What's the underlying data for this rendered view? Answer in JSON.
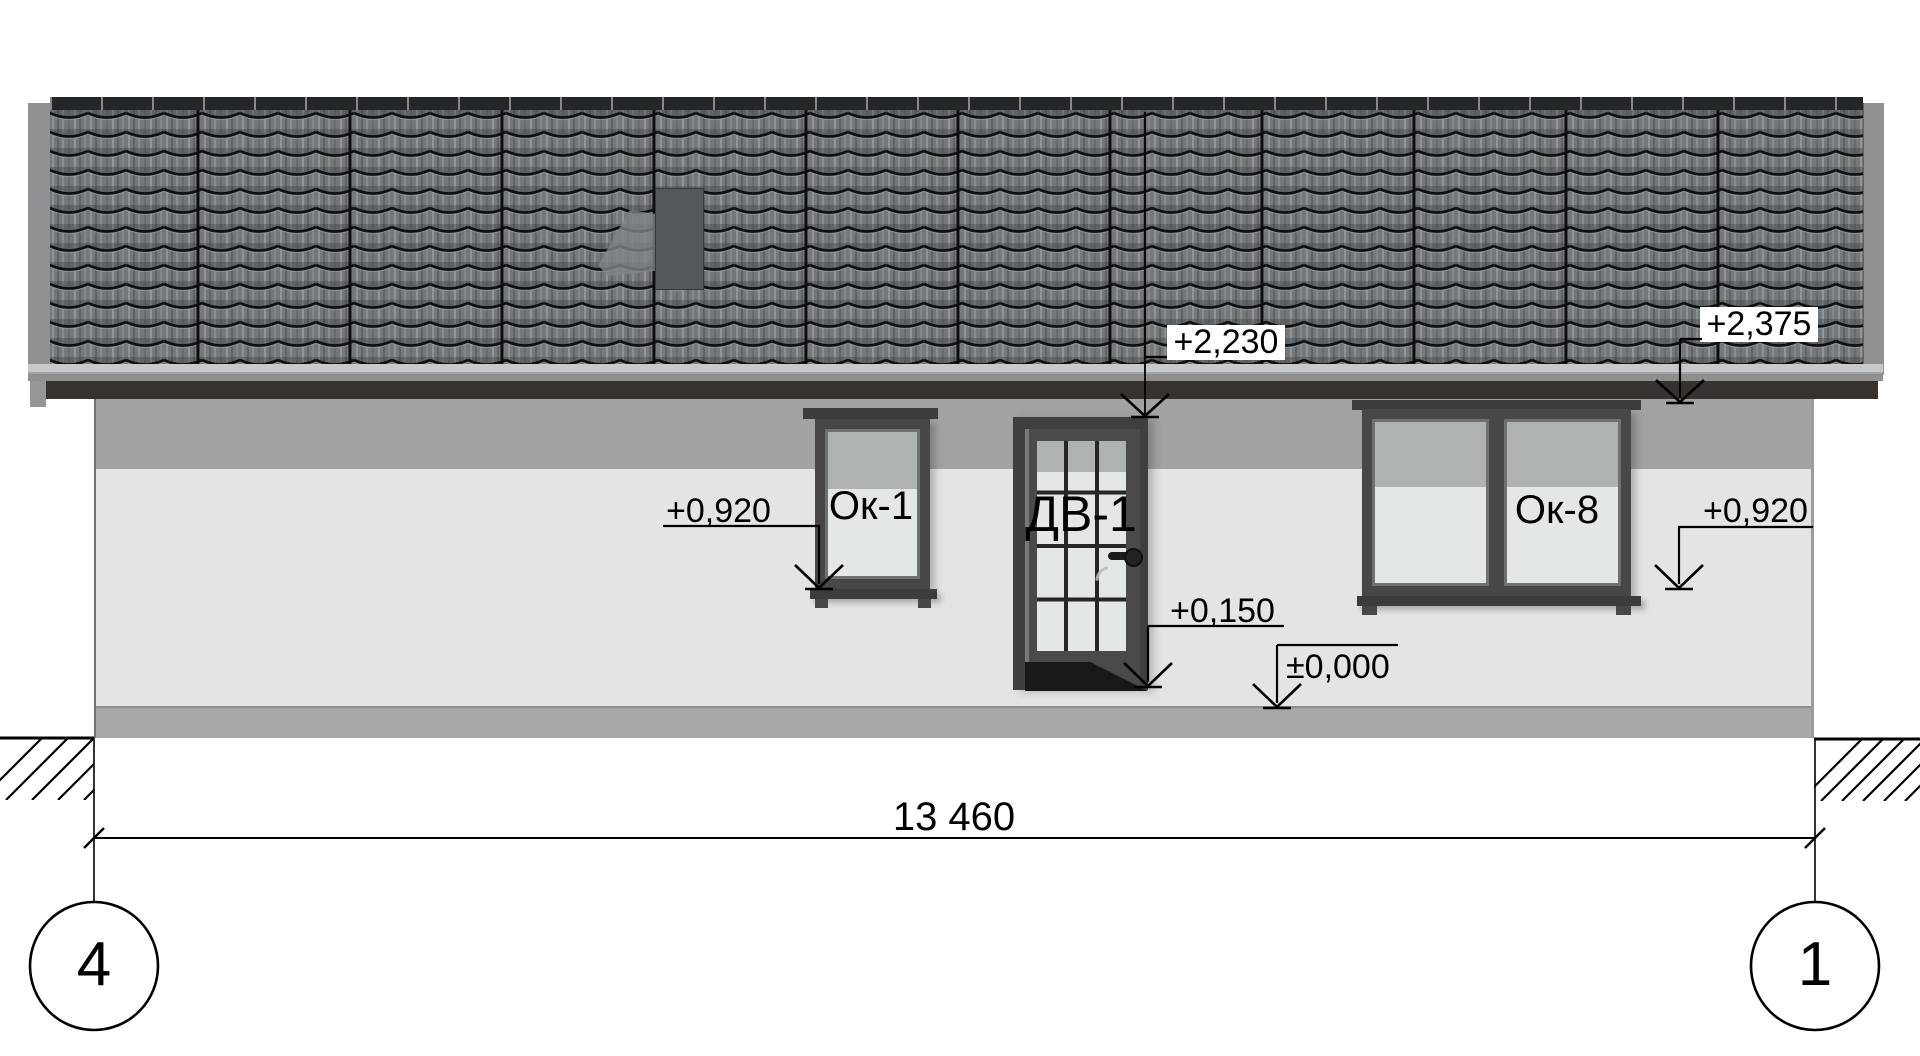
{
  "drawing": {
    "kind": "house facade elevation",
    "tags": {
      "window_left": "Ок-1",
      "door": "ДВ-1",
      "window_right": "Ок-8"
    },
    "elevation_marks": {
      "door_head": "+2,230",
      "roof_eave": "+2,375",
      "window_sill_left": "+0,920",
      "door_threshold": "+0,150",
      "ground_zero": "±0,000",
      "window_sill_right": "+0,920"
    },
    "dimension": {
      "overall_width": "13 460"
    },
    "grid_axes": {
      "left_bubble": "4",
      "right_bubble": "1"
    }
  },
  "colors": {
    "paper": "#ffffff",
    "roof_tile": "#74787b",
    "roof_row_line": "#0e1012",
    "fascia": "#37322d",
    "wall_band": "#a3a2a2",
    "wall_main": "#e4e4e4",
    "plinth": "#a9a8a8",
    "casing": "#3c3c3c",
    "frame": "#474747",
    "glass_upper": "#aeb3b0",
    "glass_lower": "#e4e8e4",
    "muntin": "#262626",
    "chimney": "#54585a"
  }
}
